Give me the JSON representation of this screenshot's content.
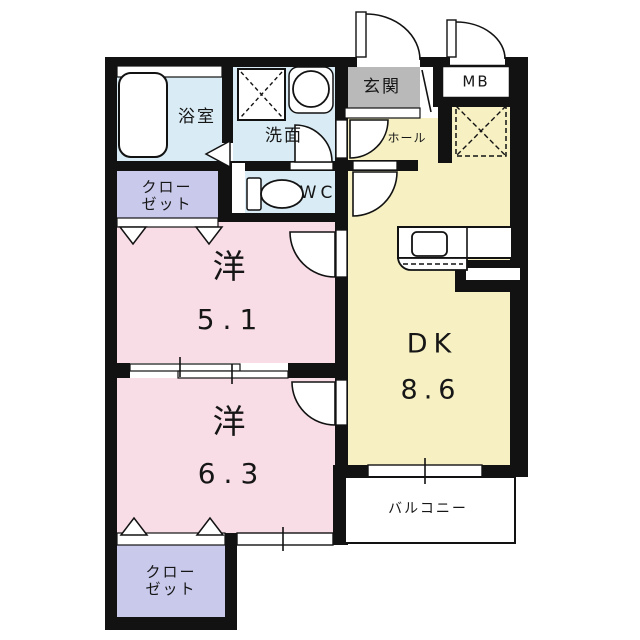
{
  "colors": {
    "wall": "#121212",
    "room_pink": "#f8dde6",
    "room_yellow": "#f6f0c2",
    "room_blue": "#d9ecf5",
    "room_purple": "#c9c9ec",
    "room_gray": "#b9b9b9",
    "white": "#ffffff",
    "text": "#161616"
  },
  "rooms": {
    "bathroom": {
      "label": "浴室"
    },
    "washroom": {
      "label": "洗面"
    },
    "entrance": {
      "label": "玄関"
    },
    "meter_box": {
      "label": "MB"
    },
    "hall": {
      "label": "ホール"
    },
    "toilet": {
      "label": "WC"
    },
    "closet_upper": {
      "line1": "クロー",
      "line2": "ゼット"
    },
    "closet_lower": {
      "line1": "クロー",
      "line2": "ゼット"
    },
    "western_room_upper": {
      "label": "洋",
      "size": "5.1"
    },
    "western_room_lower": {
      "label": "洋",
      "size": "6.3"
    },
    "dining_kitchen": {
      "label": "DK",
      "size": "8.6"
    },
    "balcony": {
      "label": "バルコニー"
    }
  }
}
